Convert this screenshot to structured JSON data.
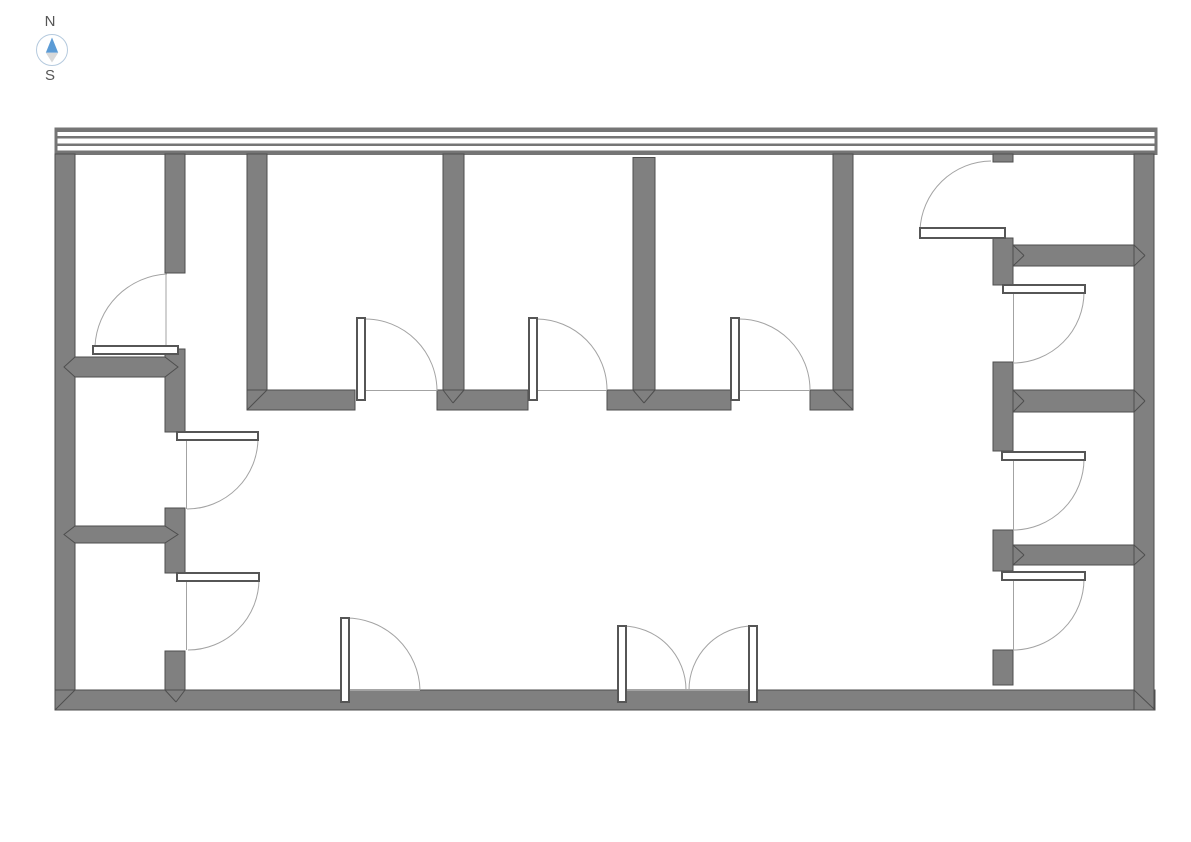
{
  "compass": {
    "north_label": "N",
    "south_label": "S"
  },
  "colors": {
    "background": "#ffffff",
    "wall_fill": "#808080",
    "wall_stroke": "#4e4e4e",
    "band_stripe": "#757575",
    "swing_line": "#a3a3a3",
    "leaf_fill": "#ffffff",
    "leaf_stroke": "#565656",
    "compass_north": "#5b9bd5",
    "compass_south": "#d9d9d9",
    "compass_ring": "#b5cade",
    "label": "#555555"
  },
  "plan": {
    "canvas_width": 1191,
    "canvas_height": 842,
    "window_band": {
      "rect": [
        55,
        128,
        1102,
        26.5
      ],
      "stripes": [
        [
          55,
          128,
          1102,
          4
        ],
        [
          55,
          136,
          1102,
          2.5
        ],
        [
          55,
          143.5,
          1102,
          2.5
        ],
        [
          55,
          150.5,
          1102,
          4
        ]
      ],
      "caps": [
        [
          55,
          128,
          2.5,
          26.5
        ],
        [
          1154.5,
          128,
          2.5,
          26.5
        ]
      ]
    },
    "walls": [
      {
        "name": "exterior-wall-west",
        "rect": [
          55,
          154,
          20,
          556
        ]
      },
      {
        "name": "exterior-wall-south",
        "rect": [
          55,
          690,
          1100,
          20
        ]
      },
      {
        "name": "exterior-wall-east",
        "rect": [
          1134,
          154,
          20,
          556
        ]
      },
      {
        "name": "interior-wall-left-a",
        "rect": [
          165,
          154,
          20,
          119
        ]
      },
      {
        "name": "interior-wall-left-b",
        "rect": [
          165,
          349,
          20,
          83
        ]
      },
      {
        "name": "interior-wall-left-c",
        "rect": [
          165,
          508,
          20,
          65
        ]
      },
      {
        "name": "interior-wall-left-d",
        "rect": [
          165,
          651,
          20,
          39
        ]
      },
      {
        "name": "partition-top-1",
        "rect": [
          247,
          154,
          20,
          256
        ]
      },
      {
        "name": "partition-top-2",
        "rect": [
          443,
          154,
          21,
          256
        ]
      },
      {
        "name": "partition-top-3",
        "rect": [
          633,
          157.5,
          22,
          252.5
        ]
      },
      {
        "name": "partition-top-4",
        "rect": [
          833,
          154,
          20,
          256
        ]
      },
      {
        "name": "corridor-wall-a",
        "rect": [
          247,
          390,
          108,
          20
        ]
      },
      {
        "name": "corridor-wall-b",
        "rect": [
          437,
          390,
          91,
          20
        ]
      },
      {
        "name": "corridor-wall-c",
        "rect": [
          607,
          390,
          124,
          20
        ]
      },
      {
        "name": "corridor-wall-d",
        "rect": [
          810,
          390,
          43,
          20
        ]
      },
      {
        "name": "right-wall-stub-top",
        "rect": [
          993,
          154,
          20,
          8
        ]
      },
      {
        "name": "right-wall-a",
        "rect": [
          993,
          238,
          20,
          47
        ]
      },
      {
        "name": "right-wall-b",
        "rect": [
          993,
          362,
          20,
          89
        ]
      },
      {
        "name": "right-wall-c",
        "rect": [
          993,
          530,
          20,
          41
        ]
      },
      {
        "name": "right-wall-stub-bottom",
        "rect": [
          993,
          650,
          20,
          35
        ]
      },
      {
        "name": "divider-right-1",
        "rect": [
          1013,
          245,
          121,
          21
        ]
      },
      {
        "name": "divider-right-2",
        "rect": [
          1013,
          390,
          121,
          22
        ]
      },
      {
        "name": "divider-right-3",
        "rect": [
          1013,
          545,
          121,
          20
        ]
      }
    ],
    "dividers_left": [
      {
        "name": "divider-left-1",
        "points": "75,357 165,357 178,367 165,377 75,377 64,367"
      },
      {
        "name": "divider-left-2",
        "points": "75,526 165,526 178,534.5 165,543 75,543 64,534.5"
      }
    ],
    "seams": [
      [
        55,
        710,
        75,
        690
      ],
      [
        1134,
        690,
        1155,
        710
      ],
      [
        247,
        410,
        267,
        390
      ],
      [
        833,
        390,
        853,
        410
      ],
      [
        443,
        390,
        453,
        403
      ],
      [
        453,
        403,
        464,
        390
      ],
      [
        633,
        390,
        644,
        403
      ],
      [
        644,
        403,
        655,
        390
      ],
      [
        165,
        690,
        176,
        702
      ],
      [
        176,
        702,
        185,
        690
      ],
      [
        1013,
        245,
        1024,
        255.5
      ],
      [
        1024,
        255.5,
        1013,
        266
      ],
      [
        1134,
        245,
        1145,
        255.5
      ],
      [
        1145,
        255.5,
        1134,
        266
      ],
      [
        1013,
        390,
        1024,
        401
      ],
      [
        1024,
        401,
        1013,
        412
      ],
      [
        1134,
        390,
        1145,
        401
      ],
      [
        1145,
        401,
        1134,
        412
      ],
      [
        1013,
        545,
        1024,
        555
      ],
      [
        1024,
        555,
        1013,
        565
      ],
      [
        1134,
        545,
        1145,
        555
      ],
      [
        1145,
        555,
        1134,
        565
      ]
    ],
    "doors": [
      {
        "name": "door-top-left-room",
        "leaf": [
          93,
          346,
          85,
          8
        ],
        "arc": "M95,346 A76,76 0 0 1 167,274",
        "jamb": [
          166,
          274,
          166,
          346
        ]
      },
      {
        "name": "door-left-room-2",
        "leaf": [
          177,
          432,
          81,
          8
        ],
        "arc": "M258,438 A71,71 0 0 1 187,509",
        "jamb": [
          186.5,
          440,
          186.5,
          509
        ]
      },
      {
        "name": "door-left-room-3",
        "leaf": [
          177,
          573,
          82,
          8
        ],
        "arc": "M259,579 A71,71 0 0 1 188,650",
        "jamb": [
          186.5,
          581,
          186.5,
          650
        ]
      },
      {
        "name": "door-corridor-1",
        "leaf": [
          357,
          318,
          8,
          82
        ],
        "arc": "M365,319 A72,72 0 0 1 437,391",
        "jamb": [
          355,
          390.5,
          437,
          390.5
        ]
      },
      {
        "name": "door-corridor-2",
        "leaf": [
          529,
          318,
          8,
          82
        ],
        "arc": "M537,319 A71,71 0 0 1 607,390",
        "jamb": [
          528,
          390.5,
          607,
          390.5
        ]
      },
      {
        "name": "door-corridor-3",
        "leaf": [
          731,
          318,
          8,
          82
        ],
        "arc": "M739,319 A71,71 0 0 1 810,390",
        "jamb": [
          731,
          390.5,
          810,
          390.5
        ]
      },
      {
        "name": "door-entry-single",
        "leaf": [
          341,
          618,
          8,
          84
        ],
        "arc": "M345,618 A74,74 0 0 1 420,690",
        "jamb": [
          349,
          690.5,
          420,
          690.5
        ]
      },
      {
        "name": "door-entry-double-left",
        "leaf": [
          618,
          626,
          8,
          76
        ],
        "arc": "M622,626 A64,64 0 0 1 686,690",
        "jamb": [
          626,
          690.5,
          749,
          690.5
        ]
      },
      {
        "name": "door-entry-double-right",
        "leaf": [
          749,
          626,
          8,
          76
        ],
        "arc": "M753,626 A64,64 0 0 0 689,690",
        "jamb": null
      },
      {
        "name": "door-right-room-1",
        "leaf": [
          920,
          228,
          85,
          10
        ],
        "arc": "M920,230 A72,72 0 0 1 991,161",
        "jamb": null
      },
      {
        "name": "door-right-room-2",
        "leaf": [
          1003,
          285,
          82,
          8
        ],
        "arc": "M1084,292 A71,71 0 0 1 1013,363",
        "jamb": [
          1013.5,
          293,
          1013.5,
          362
        ]
      },
      {
        "name": "door-right-room-3",
        "leaf": [
          1002,
          452,
          83,
          8
        ],
        "arc": "M1084,459 A71,71 0 0 1 1013,530",
        "jamb": [
          1013.5,
          460,
          1013.5,
          530
        ]
      },
      {
        "name": "door-right-room-4",
        "leaf": [
          1002,
          572,
          83,
          8
        ],
        "arc": "M1084,579 A71,71 0 0 1 1013,650",
        "jamb": [
          1013.5,
          580,
          1013.5,
          650
        ]
      }
    ]
  }
}
